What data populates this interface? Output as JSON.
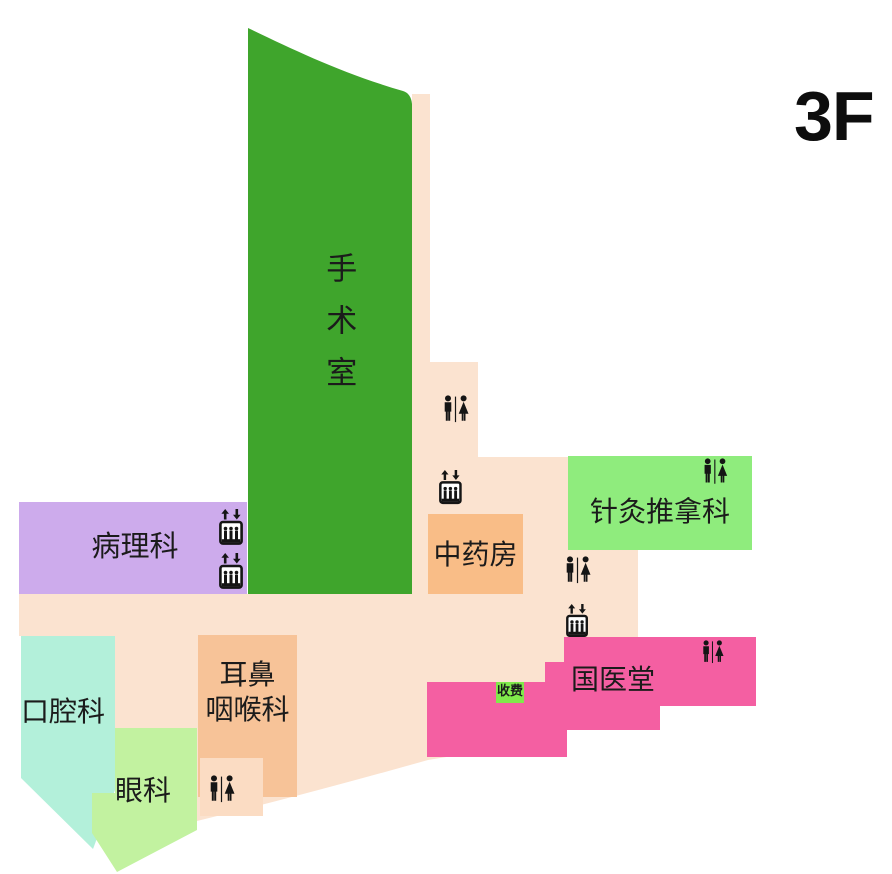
{
  "floor": {
    "label": "3F"
  },
  "plan": {
    "background_color": "#fbe3d0",
    "text_color": "#1b1b1b"
  },
  "rooms": {
    "operating_room": {
      "label": "手术室",
      "color": "#3fa52c"
    },
    "pathology": {
      "label": "病理科",
      "color": "#cdabec"
    },
    "chinese_pharmacy": {
      "label": "中药房",
      "color": "#f9bd87"
    },
    "acupuncture_massage": {
      "label": "针灸推拿科",
      "color": "#8fec7d"
    },
    "tcm_hall": {
      "label": "国医堂",
      "color": "#f45fa2"
    },
    "cashier": {
      "label": "收费",
      "color": "#80e94b"
    },
    "oral": {
      "label": "口腔科",
      "color": "#b3f0da"
    },
    "ent": {
      "label": "耳鼻咽喉科",
      "line1": "耳鼻",
      "line2": "咽喉科",
      "color": "#f7c398",
      "annex_color": "#fbdcc3"
    },
    "ophthalmology": {
      "label": "眼科",
      "color": "#c2f2a0"
    }
  },
  "icons": {
    "restroom": "restroom-icon",
    "elevator": "elevator-icon"
  }
}
